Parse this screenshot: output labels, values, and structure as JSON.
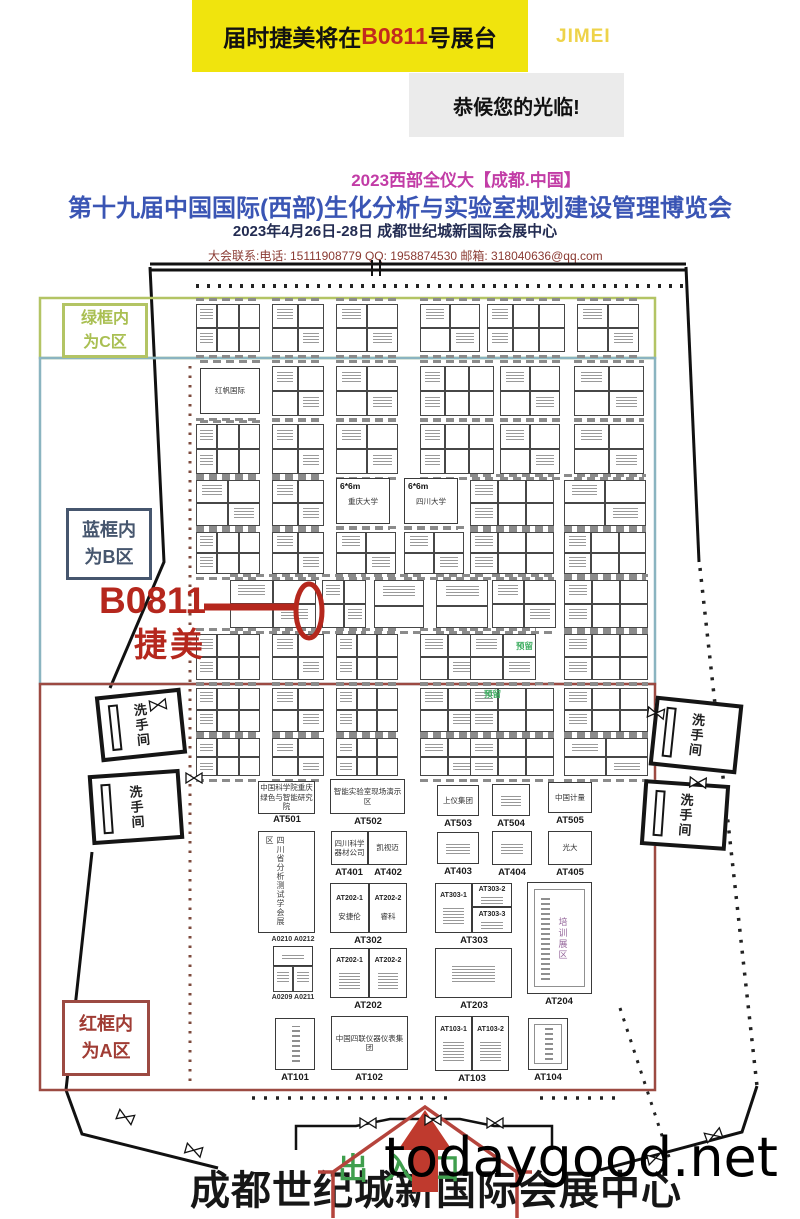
{
  "banner": {
    "pre": "届时捷美将在",
    "booth_no": "B0811",
    "post": "号展台",
    "logo": "JIMEI",
    "welcome": "恭候您的光临!"
  },
  "title": {
    "line1": "2023西部全仪大【成都.中国】",
    "line2": "第十九届中国国际(西部)生化分析与实验室规划建设管理博览会",
    "line3": "2023年4月26日-28日 成都世纪城新国际会展中心",
    "contact": "大会联系:电话: 15111908779    QQ: 1958874530   邮箱: 318040636@qq.com"
  },
  "zones": {
    "c": {
      "line1": "绿框内",
      "line2": "为C区",
      "color": "#a9bf52"
    },
    "b": {
      "line1": "蓝框内",
      "line2": "为B区",
      "color": "#46566e"
    },
    "a": {
      "line1": "红框内",
      "line2": "为A区",
      "color": "#a03c34"
    }
  },
  "annotation": {
    "booth": "B0811",
    "name": "捷美",
    "color": "#b5271d"
  },
  "footer": {
    "entrance": "出入口",
    "venue": "成都世纪城新国际会展中心",
    "watermark": "todaygood.net"
  },
  "floorplan": {
    "restroom": "洗手间",
    "reserved": "预留",
    "training_zone": "培训展区",
    "assoc_left": "四川省分析测试学会展区",
    "named_small": "红帆国际",
    "six_booths": [
      {
        "size": "6*6m",
        "name": "重庆大学"
      },
      {
        "size": "6*6m",
        "name": "四川大学"
      }
    ],
    "big_booths": [
      {
        "code": "AT501",
        "name": "中国科学院重庆绿色与智能研究院"
      },
      {
        "code": "AT502",
        "name": "智能实验室现场演示区"
      },
      {
        "code": "AT503",
        "name": "上仪集团"
      },
      {
        "code": "AT504",
        "name": ""
      },
      {
        "code": "AT505",
        "name": "中国计量"
      },
      {
        "code": "AT401",
        "name": "四川科学器材公司"
      },
      {
        "code": "AT402",
        "name": "凯视迈"
      },
      {
        "code": "AT403",
        "name": ""
      },
      {
        "code": "AT404",
        "name": ""
      },
      {
        "code": "AT405",
        "name": "光大"
      },
      {
        "code": "AT302",
        "subs": [
          {
            "code": "AT202-1",
            "name": "安捷伦"
          },
          {
            "code": "AT202-2",
            "name": "睿科"
          }
        ]
      },
      {
        "code": "AT303",
        "subs": [
          {
            "code": "AT303-1",
            "name": ""
          },
          {
            "code": "AT303-2",
            "name": ""
          },
          {
            "code": "AT303-3",
            "name": ""
          }
        ]
      },
      {
        "code": "AT202",
        "subs": [
          {
            "code": "AT202-1",
            "name": ""
          },
          {
            "code": "AT202-2",
            "name": ""
          }
        ]
      },
      {
        "code": "AT203",
        "name": ""
      },
      {
        "code": "AT204",
        "name": ""
      },
      {
        "code": "AT101",
        "name": ""
      },
      {
        "code": "AT102",
        "name": "中国四联仪器仪表集团"
      },
      {
        "code": "AT103",
        "subs": [
          {
            "code": "AT103-1",
            "name": ""
          },
          {
            "code": "AT103-2",
            "name": ""
          }
        ]
      },
      {
        "code": "AT104",
        "name": ""
      }
    ],
    "small_codes": [
      "A0210",
      "A0212",
      "A0209",
      "A0211"
    ]
  }
}
